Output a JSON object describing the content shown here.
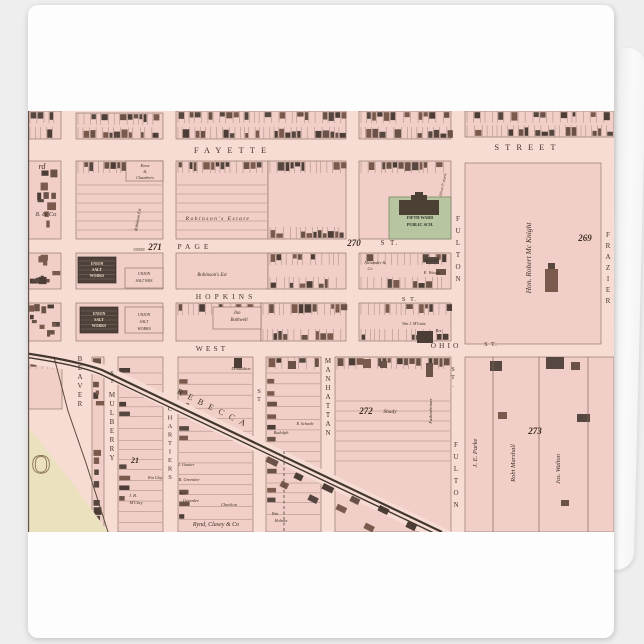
{
  "product": {
    "kind": "folded greeting card with antique ward map print"
  },
  "map": {
    "colors": {
      "street_bg": "#f7dcd4",
      "block": "#f1cfc8",
      "line": "#82695a",
      "building_darks": [
        "#564840",
        "#4c3e36",
        "#6b5248",
        "#7a5a4c"
      ],
      "school_green": "#b7c6a0",
      "school_border": "#7e8468",
      "salt_dark": "#4e413a",
      "salt_hatch": "#d8c5b6",
      "cream": "#ece1bf",
      "rail": "#42382f",
      "text_street": "#42352a",
      "text_num": "#3c2e22",
      "text_own": "#3a2d22",
      "text_light": "#eddcc8",
      "text_school": "#33302a",
      "big_o": "#8a7455",
      "neatline": "#5d4c40",
      "shore": "#5a4a3e"
    },
    "size": {
      "w": 586,
      "h": 421
    },
    "blocks": [
      {
        "x": 0,
        "y": 0,
        "w": 33,
        "h": 28,
        "t": "tb"
      },
      {
        "x": 48,
        "y": 2,
        "w": 87,
        "h": 26,
        "t": "tb"
      },
      {
        "x": 148,
        "y": 0,
        "w": 170,
        "h": 28,
        "t": "tb"
      },
      {
        "x": 331,
        "y": 0,
        "w": 92,
        "h": 28,
        "t": "tb"
      },
      {
        "x": 437,
        "y": 0,
        "w": 149,
        "h": 26,
        "t": "tb"
      },
      {
        "x": 0,
        "y": 50,
        "w": 33,
        "h": 78,
        "t": "sp",
        "d": 0.22
      },
      {
        "x": 0,
        "y": 142,
        "w": 33,
        "h": 36,
        "t": "sp",
        "d": 0.5
      },
      {
        "x": 0,
        "y": 192,
        "w": 33,
        "h": 38,
        "t": "sp",
        "d": 0.5
      },
      {
        "x": 48,
        "y": 50,
        "w": 87,
        "h": 78,
        "t": "th"
      },
      {
        "x": 148,
        "y": 50,
        "w": 92,
        "h": 78,
        "t": "th"
      },
      {
        "x": 240,
        "y": 50,
        "w": 78,
        "h": 78,
        "t": "tb"
      },
      {
        "x": 331,
        "y": 50,
        "w": 92,
        "h": 78,
        "t": "t"
      },
      {
        "x": 437,
        "y": 52,
        "w": 136,
        "h": 181,
        "t": "no"
      },
      {
        "x": 48,
        "y": 142,
        "w": 87,
        "h": 36,
        "t": "no"
      },
      {
        "x": 148,
        "y": 142,
        "w": 92,
        "h": 36,
        "t": "no"
      },
      {
        "x": 240,
        "y": 142,
        "w": 78,
        "h": 36,
        "t": "tb"
      },
      {
        "x": 331,
        "y": 142,
        "w": 92,
        "h": 36,
        "t": "tb",
        "d": 0.45
      },
      {
        "x": 48,
        "y": 192,
        "w": 87,
        "h": 38,
        "t": "no"
      },
      {
        "x": 148,
        "y": 192,
        "w": 85,
        "h": 38,
        "t": "t",
        "d": 0.5
      },
      {
        "x": 233,
        "y": 192,
        "w": 85,
        "h": 38,
        "t": "tb"
      },
      {
        "x": 331,
        "y": 192,
        "w": 92,
        "h": 38,
        "t": "tb",
        "d": 0.4
      },
      {
        "x": 0,
        "y": 246,
        "w": 34,
        "h": 52,
        "t": "t",
        "d": 0.5
      },
      {
        "x": 64,
        "y": 246,
        "w": 12,
        "h": 175,
        "t": "sp",
        "d": 0.35
      },
      {
        "x": 90,
        "y": 246,
        "w": 45,
        "h": 175,
        "t": "st"
      },
      {
        "x": 150,
        "y": 246,
        "w": 75,
        "h": 175,
        "t": "st"
      },
      {
        "x": 238,
        "y": 246,
        "w": 55,
        "h": 175,
        "t": "st2"
      },
      {
        "x": 307,
        "y": 246,
        "w": 116,
        "h": 175,
        "t": "th2"
      },
      {
        "x": 437,
        "y": 246,
        "w": 149,
        "h": 175,
        "t": "no"
      }
    ],
    "boxes": [
      {
        "x": 98,
        "y": 50,
        "w": 37,
        "h": 20
      },
      {
        "x": 185,
        "y": 196,
        "w": 48,
        "h": 22
      },
      {
        "x": 97,
        "y": 157,
        "w": 38,
        "h": 20
      },
      {
        "x": 97,
        "y": 196,
        "w": 38,
        "h": 26
      }
    ],
    "school": {
      "green": {
        "x": 361,
        "y": 86,
        "w": 62,
        "h": 42
      },
      "building": [
        [
          371,
          89,
          40,
          15
        ],
        [
          383,
          84,
          16,
          6
        ],
        [
          387,
          81,
          8,
          4
        ]
      ]
    },
    "salt_dark": [
      {
        "x": 50,
        "y": 146,
        "w": 38,
        "h": 26
      },
      {
        "x": 52,
        "y": 196,
        "w": 38,
        "h": 26
      }
    ],
    "cream_poly": [
      [
        0,
        316
      ],
      [
        12,
        330
      ],
      [
        46,
        374
      ],
      [
        80,
        421
      ],
      [
        0,
        421
      ]
    ],
    "shore_path": "M26,246 L40,300 L58,352 L80,421",
    "diag_band": [
      [
        -4,
        236
      ],
      [
        78,
        254
      ],
      [
        424,
        421
      ],
      [
        392,
        421
      ],
      [
        70,
        264
      ],
      [
        -4,
        252
      ]
    ],
    "rails": [
      "M-4,242 C30,247 55,252 74,259 L414,421",
      "M-4,246 C30,251 55,256 72,263 L410,424"
    ],
    "diag_buildings": {
      "x0": 240,
      "y0": 352,
      "dx": 14,
      "dy": 6.9,
      "n": 13,
      "angle": 26
    },
    "dashed_spur": {
      "x": 256,
      "y1": 340,
      "y2": 421
    },
    "parcel_lines": [
      {
        "x": 465,
        "y1": 246,
        "y2": 421
      },
      {
        "x": 511,
        "y1": 246,
        "y2": 421
      },
      {
        "x": 560,
        "y1": 246,
        "y2": 421
      }
    ],
    "houses": [
      [
        520,
        152,
        7,
        6
      ],
      [
        517,
        158,
        13,
        23
      ],
      [
        462,
        250,
        12,
        10
      ],
      [
        518,
        246,
        18,
        12
      ],
      [
        543,
        251,
        9,
        8
      ],
      [
        470,
        301,
        9,
        7
      ],
      [
        549,
        303,
        13,
        8
      ],
      [
        533,
        389,
        8,
        6
      ],
      [
        398,
        252,
        7,
        14
      ],
      [
        389,
        220,
        16,
        12
      ],
      [
        398,
        146,
        13,
        7
      ],
      [
        408,
        158,
        10,
        6
      ],
      [
        206,
        247,
        8,
        10
      ],
      [
        260,
        250,
        8,
        8
      ],
      [
        335,
        248,
        8,
        9
      ],
      [
        352,
        250,
        7,
        7
      ]
    ],
    "labels": [
      {
        "t": "FAYETTE",
        "x": 205,
        "y": 42,
        "s": 8.5,
        "ls": 6,
        "k": "street"
      },
      {
        "t": "STREET",
        "x": 500,
        "y": 39,
        "s": 8.5,
        "ls": 6,
        "k": "street"
      },
      {
        "t": "PAGE",
        "x": 167,
        "y": 138,
        "s": 7.5,
        "ls": 4,
        "k": "street"
      },
      {
        "t": "S T.",
        "x": 362,
        "y": 134,
        "s": 7,
        "ls": 2,
        "k": "street"
      },
      {
        "t": "HOPKINS",
        "x": 198,
        "y": 188,
        "s": 7.5,
        "ls": 4,
        "k": "street"
      },
      {
        "t": "S T.",
        "x": 382,
        "y": 190,
        "s": 6.5,
        "ls": 1.5,
        "k": "street"
      },
      {
        "t": "WEST",
        "x": 184,
        "y": 240,
        "s": 7.5,
        "ls": 3,
        "k": "street"
      },
      {
        "t": "OHIO",
        "x": 418,
        "y": 237,
        "s": 7.5,
        "ls": 3,
        "k": "street"
      },
      {
        "t": "S T.",
        "x": 463,
        "y": 235,
        "s": 6,
        "ls": 1,
        "k": "street"
      },
      {
        "t": "REBECCA",
        "x": 185,
        "y": 300,
        "s": 8.5,
        "ls": 6,
        "k": "street",
        "rot": 26
      },
      {
        "t": "MANHATTAN",
        "x": 300,
        "y": 252,
        "s": 7,
        "st": 9,
        "k": "street"
      },
      {
        "t": "ST",
        "x": 231,
        "y": 282,
        "s": 6.5,
        "st": 8,
        "k": "street"
      },
      {
        "t": "ST",
        "x": 84,
        "y": 264,
        "s": 6,
        "st": 8,
        "k": "street"
      },
      {
        "t": "MULBERRY",
        "x": 84,
        "y": 286,
        "s": 7,
        "st": 9,
        "k": "street"
      },
      {
        "t": "BEAVER",
        "x": 52,
        "y": 250,
        "s": 7,
        "st": 9,
        "k": "street"
      },
      {
        "t": "CHARTIERS",
        "x": 142,
        "y": 300,
        "s": 6.5,
        "st": 8.5,
        "k": "street"
      },
      {
        "t": "FULTON",
        "x": 430,
        "y": 110,
        "s": 7,
        "st": 12,
        "k": "street"
      },
      {
        "t": "ST.",
        "x": 425,
        "y": 260,
        "s": 6,
        "st": 8,
        "k": "street"
      },
      {
        "t": "FULTON",
        "x": 428,
        "y": 336,
        "s": 7,
        "st": 12,
        "k": "street"
      },
      {
        "t": "FRAZIER",
        "x": 580,
        "y": 126,
        "s": 7,
        "st": 11,
        "k": "street"
      },
      {
        "t": "271",
        "x": 127,
        "y": 139,
        "s": 9,
        "k": "num"
      },
      {
        "t": "270",
        "x": 326,
        "y": 135,
        "s": 9,
        "k": "num"
      },
      {
        "t": "269",
        "x": 557,
        "y": 130,
        "s": 9,
        "k": "num"
      },
      {
        "t": "272",
        "x": 338,
        "y": 303,
        "s": 9,
        "k": "num"
      },
      {
        "t": "273",
        "x": 507,
        "y": 323,
        "s": 9,
        "k": "num"
      },
      {
        "t": "21",
        "x": 107,
        "y": 352,
        "s": 8,
        "k": "num"
      },
      {
        "t": "Shady",
        "x": 362,
        "y": 302,
        "s": 5.5,
        "k": "own"
      },
      {
        "t": "rd",
        "x": 14,
        "y": 58,
        "s": 8,
        "k": "own"
      },
      {
        "t": "8. & Co",
        "x": 18,
        "y": 105,
        "s": 6.5,
        "k": "own"
      },
      {
        "t": "Knox",
        "x": 117,
        "y": 56,
        "s": 4.3,
        "k": "own"
      },
      {
        "t": "&",
        "x": 117,
        "y": 62,
        "s": 4.3,
        "k": "own"
      },
      {
        "t": "Chambers",
        "x": 117,
        "y": 68,
        "s": 4.3,
        "k": "own"
      },
      {
        "t": "Robinson Est",
        "x": 111,
        "y": 109,
        "s": 4.3,
        "k": "own",
        "rot": -80
      },
      {
        "t": "Robinson's  Estate",
        "x": 190,
        "y": 109,
        "s": 5.5,
        "ls": 1.5,
        "k": "own"
      },
      {
        "t": "Robinson's Est",
        "x": 184,
        "y": 165,
        "s": 5,
        "k": "own"
      },
      {
        "t": "Jno",
        "x": 209,
        "y": 203,
        "s": 4.8,
        "k": "own"
      },
      {
        "t": "Bothwell",
        "x": 211,
        "y": 210,
        "s": 4.8,
        "k": "own"
      },
      {
        "t": "Hon. Robert Mc Knight",
        "x": 503,
        "y": 147,
        "s": 7.5,
        "k": "own",
        "rot": -90
      },
      {
        "t": "Alexander &",
        "x": 347,
        "y": 153,
        "s": 4.2,
        "k": "own"
      },
      {
        "t": "Co",
        "x": 342,
        "y": 159,
        "s": 4.2,
        "k": "own"
      },
      {
        "t": "Stewart",
        "x": 404,
        "y": 151,
        "s": 4.8,
        "k": "own"
      },
      {
        "t": "E. Woods",
        "x": 404,
        "y": 163,
        "s": 4.4,
        "k": "own"
      },
      {
        "t": "Wm J. M'Guire",
        "x": 386,
        "y": 214,
        "s": 3.9,
        "k": "own"
      },
      {
        "t": "Res.",
        "x": 411,
        "y": 221,
        "s": 3.9,
        "k": "own"
      },
      {
        "t": "Oliver P. searle",
        "x": 416,
        "y": 74,
        "s": 3.8,
        "k": "own",
        "rot": -78
      },
      {
        "t": "Donaldson",
        "x": 213,
        "y": 259,
        "s": 4.4,
        "k": "own"
      },
      {
        "t": "Rudolph",
        "x": 253,
        "y": 323,
        "s": 4.4,
        "k": "own"
      },
      {
        "t": "R. Schacht",
        "x": 277,
        "y": 314,
        "s": 4,
        "k": "own"
      },
      {
        "t": "J. Gunter",
        "x": 158,
        "y": 355,
        "s": 4.4,
        "k": "own"
      },
      {
        "t": "R. Greenlee",
        "x": 161,
        "y": 370,
        "s": 4.4,
        "k": "own"
      },
      {
        "t": "Rob",
        "x": 155,
        "y": 384,
        "s": 4.4,
        "k": "own"
      },
      {
        "t": "Greenlee",
        "x": 163,
        "y": 391,
        "s": 4.4,
        "k": "own"
      },
      {
        "t": "Charlton",
        "x": 201,
        "y": 395,
        "s": 4.4,
        "k": "own"
      },
      {
        "t": "J. B.",
        "x": 105,
        "y": 386,
        "s": 4.4,
        "k": "own"
      },
      {
        "t": "M'Clay",
        "x": 108,
        "y": 393,
        "s": 4.4,
        "k": "own"
      },
      {
        "t": "Wm Clay",
        "x": 127,
        "y": 368,
        "s": 4,
        "k": "own"
      },
      {
        "t": "Rynd, Clasey & Co",
        "x": 188,
        "y": 415,
        "s": 6,
        "k": "own"
      },
      {
        "t": "Wm",
        "x": 247,
        "y": 404,
        "s": 4.2,
        "k": "own"
      },
      {
        "t": "Holmes",
        "x": 253,
        "y": 411,
        "s": 4.2,
        "k": "own"
      },
      {
        "t": "Fashenheimer",
        "x": 404,
        "y": 300,
        "s": 4.4,
        "k": "own",
        "rot": -90
      },
      {
        "t": "J. E. Parke",
        "x": 449,
        "y": 342,
        "s": 6.5,
        "k": "own",
        "rot": -90
      },
      {
        "t": "Robt Marshall",
        "x": 487,
        "y": 352,
        "s": 6.5,
        "k": "own",
        "rot": -90
      },
      {
        "t": "Jos. Walton",
        "x": 532,
        "y": 358,
        "s": 6.5,
        "k": "own",
        "rot": -90
      },
      {
        "t": "UNION",
        "x": 111,
        "y": 140,
        "s": 3.6,
        "k": "own"
      },
      {
        "t": "FIFTH WARD",
        "x": 392,
        "y": 108,
        "s": 4.2,
        "k": "school"
      },
      {
        "t": "PUBLIC SCH.",
        "x": 392,
        "y": 115,
        "s": 4.2,
        "k": "school"
      },
      {
        "t": "UNION",
        "x": 69,
        "y": 154,
        "s": 3.8,
        "k": "light"
      },
      {
        "t": "SALT",
        "x": 69,
        "y": 160,
        "s": 3.8,
        "k": "light"
      },
      {
        "t": "WORKS",
        "x": 69,
        "y": 166,
        "s": 3.8,
        "k": "light"
      },
      {
        "t": "UNION",
        "x": 116,
        "y": 164,
        "s": 4,
        "k": "own"
      },
      {
        "t": "SALT WKS",
        "x": 116,
        "y": 171,
        "s": 3.8,
        "k": "own"
      },
      {
        "t": "UNION",
        "x": 71,
        "y": 204,
        "s": 3.8,
        "k": "light"
      },
      {
        "t": "SALT",
        "x": 71,
        "y": 210,
        "s": 3.8,
        "k": "light"
      },
      {
        "t": "WORKS",
        "x": 71,
        "y": 216,
        "s": 3.8,
        "k": "light"
      },
      {
        "t": "UNION",
        "x": 116,
        "y": 205,
        "s": 4,
        "k": "own"
      },
      {
        "t": "SALT",
        "x": 116,
        "y": 212,
        "s": 4,
        "k": "own"
      },
      {
        "t": "WORKS",
        "x": 116,
        "y": 219,
        "s": 4,
        "k": "own"
      },
      {
        "t": "O",
        "x": 13,
        "y": 362,
        "s": 26,
        "k": "big"
      }
    ]
  }
}
